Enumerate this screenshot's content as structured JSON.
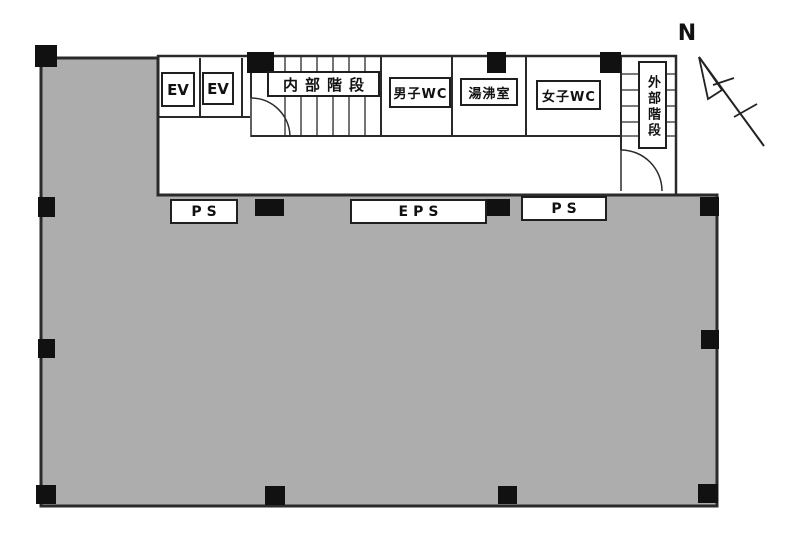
{
  "colors": {
    "floor": "#ADADAD",
    "wall": "#2a2a2a",
    "column": "#111111",
    "room_bg": "#ffffff"
  },
  "compass": {
    "north_label": "N"
  },
  "labels": {
    "ev1": "EV",
    "ev2": "EV",
    "internal_stairs": "内部階段",
    "mens_wc": "男子WC",
    "kitchenette": "湯沸室",
    "womens_wc": "女子WC",
    "external_stairs": "外部階段",
    "ps_left": "PS",
    "eps": "EPS",
    "ps_right": "PS"
  }
}
